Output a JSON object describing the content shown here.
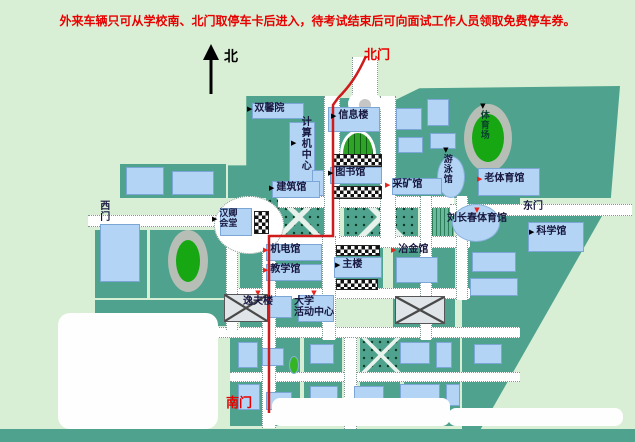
{
  "header": {
    "notice": "外来车辆只可从学校南、北门取停车卡后进入，待考试结束后可向面试工作人员领取免费停车券。",
    "north_label": "北"
  },
  "palette": {
    "background": "#d9efd5",
    "parcel_teal": "#4fa28d",
    "building_blue": "#b3d4f4",
    "route_red": "#cf1b1b",
    "gate_red": "#e80000",
    "field_green": "#17a713",
    "track_gray": "#b7beb5",
    "label_dark": "#17173f"
  },
  "map": {
    "parcels": [
      {
        "type": "teal",
        "x": 392,
        "y": 86,
        "w": 228,
        "h": 112,
        "clip": "polygon(0 14%, 12% 2%, 100% 0, 96% 100%, 0 100%)"
      },
      {
        "type": "teal",
        "x": 462,
        "y": 216,
        "w": 140,
        "h": 214,
        "clip": "polygon(0 0, 100% 0, 13% 100%, 0 100%)"
      },
      {
        "type": "teal",
        "x": 326,
        "y": 98,
        "w": 58,
        "h": 100
      },
      {
        "type": "teal",
        "x": 228,
        "y": 96,
        "w": 96,
        "h": 102,
        "clip": "polygon(19% 0,100% 0,100% 100%,0 100%,0 68%,19% 68%)"
      },
      {
        "type": "teal",
        "x": 120,
        "y": 164,
        "w": 106,
        "h": 34
      },
      {
        "type": "teal",
        "x": 95,
        "y": 230,
        "w": 52,
        "h": 68
      },
      {
        "type": "teal",
        "x": 150,
        "y": 230,
        "w": 80,
        "h": 68
      },
      {
        "type": "teal",
        "x": 95,
        "y": 300,
        "w": 133,
        "h": 26
      },
      {
        "type": "teal",
        "x": 240,
        "y": 244,
        "w": 82,
        "h": 46
      },
      {
        "type": "teal",
        "x": 335,
        "y": 244,
        "w": 48,
        "h": 46
      },
      {
        "type": "teal",
        "x": 393,
        "y": 244,
        "w": 62,
        "h": 46
      },
      {
        "type": "teal",
        "x": 240,
        "y": 292,
        "w": 92,
        "h": 36
      },
      {
        "type": "teal",
        "x": 393,
        "y": 292,
        "w": 62,
        "h": 36
      },
      {
        "type": "teal",
        "x": 466,
        "y": 197,
        "w": 54,
        "h": 48
      },
      {
        "type": "teal",
        "x": 230,
        "y": 338,
        "w": 70,
        "h": 34
      },
      {
        "type": "teal",
        "x": 304,
        "y": 338,
        "w": 38,
        "h": 34
      },
      {
        "type": "teal",
        "x": 394,
        "y": 338,
        "w": 66,
        "h": 34
      },
      {
        "type": "teal",
        "x": 230,
        "y": 378,
        "w": 70,
        "h": 48
      },
      {
        "type": "teal",
        "x": 304,
        "y": 378,
        "w": 38,
        "h": 48
      },
      {
        "type": "teal",
        "x": 360,
        "y": 378,
        "w": 40,
        "h": 48
      },
      {
        "type": "teal",
        "x": 404,
        "y": 378,
        "w": 56,
        "h": 48
      },
      {
        "type": "band",
        "x": 0,
        "y": 429,
        "w": 635,
        "h": 13
      },
      {
        "type": "park",
        "x": 266,
        "y": 197,
        "w": 66,
        "h": 40
      },
      {
        "type": "park",
        "x": 344,
        "y": 197,
        "w": 74,
        "h": 40
      },
      {
        "type": "grass",
        "x": 420,
        "y": 199,
        "w": 34,
        "h": 40
      },
      {
        "type": "park",
        "x": 360,
        "y": 338,
        "w": 42,
        "h": 34
      },
      {
        "type": "hatch",
        "x": 224,
        "y": 294,
        "w": 44,
        "h": 28
      },
      {
        "type": "hatch",
        "x": 395,
        "y": 296,
        "w": 50,
        "h": 28
      }
    ],
    "roads": [
      {
        "dir": "h",
        "x": 88,
        "y": 215,
        "w": 132,
        "h": 12
      },
      {
        "dir": "h",
        "x": 278,
        "y": 196,
        "w": 176,
        "h": 12
      },
      {
        "dir": "h",
        "x": 450,
        "y": 204,
        "w": 182,
        "h": 12
      },
      {
        "dir": "h",
        "x": 262,
        "y": 236,
        "w": 208,
        "h": 12
      },
      {
        "dir": "h",
        "x": 232,
        "y": 288,
        "w": 238,
        "h": 11
      },
      {
        "dir": "h",
        "x": 120,
        "y": 327,
        "w": 400,
        "h": 11
      },
      {
        "dir": "h",
        "x": 230,
        "y": 372,
        "w": 290,
        "h": 10
      },
      {
        "dir": "v",
        "x": 352,
        "y": 57,
        "w": 26,
        "h": 40
      },
      {
        "dir": "v",
        "x": 324,
        "y": 96,
        "w": 16,
        "h": 142
      },
      {
        "dir": "v",
        "x": 380,
        "y": 96,
        "w": 16,
        "h": 142
      },
      {
        "dir": "v",
        "x": 226,
        "y": 210,
        "w": 12,
        "h": 120
      },
      {
        "dir": "v",
        "x": 262,
        "y": 236,
        "w": 14,
        "h": 192
      },
      {
        "dir": "v",
        "x": 322,
        "y": 236,
        "w": 14,
        "h": 104
      },
      {
        "dir": "v",
        "x": 420,
        "y": 196,
        "w": 12,
        "h": 144
      },
      {
        "dir": "v",
        "x": 456,
        "y": 196,
        "w": 12,
        "h": 104
      },
      {
        "dir": "v",
        "x": 344,
        "y": 338,
        "w": 13,
        "h": 91
      }
    ],
    "specials": [
      {
        "type": "island",
        "x": 214,
        "y": 196,
        "w": 68,
        "h": 56
      },
      {
        "type": "plaza",
        "x": 348,
        "y": 90,
        "w": 34,
        "h": 28
      },
      {
        "type": "dot",
        "x": 359,
        "y": 99,
        "w": 12,
        "h": 12
      },
      {
        "type": "blob",
        "x": 58,
        "y": 313,
        "w": 160,
        "h": 116,
        "rx": "12px"
      },
      {
        "type": "blob",
        "x": 272,
        "y": 398,
        "w": 178,
        "h": 28,
        "rx": "8px"
      },
      {
        "type": "blob",
        "x": 448,
        "y": 408,
        "w": 175,
        "h": 18,
        "rx": "8px"
      }
    ],
    "stadiums": [
      {
        "x": 168,
        "y": 230,
        "w": 40,
        "h": 62,
        "inset": "10px 8px"
      },
      {
        "x": 464,
        "y": 104,
        "w": 48,
        "h": 68,
        "inset": "10px 8px"
      }
    ],
    "ellipses": [
      {
        "x": 437,
        "y": 156,
        "w": 28,
        "h": 42,
        "c": "#b3d4f4"
      },
      {
        "x": 452,
        "y": 204,
        "w": 48,
        "h": 38,
        "c": "#b3d4f4"
      },
      {
        "x": 289,
        "y": 356,
        "w": 10,
        "h": 18,
        "c": "#35b524"
      }
    ],
    "dome": {
      "x": 340,
      "y": 130,
      "w": 36,
      "h": 24
    },
    "checkers": [
      {
        "x": 332,
        "y": 154,
        "w": 50,
        "h": 13
      },
      {
        "x": 332,
        "y": 186,
        "w": 50,
        "h": 13
      },
      {
        "x": 336,
        "y": 245,
        "w": 44,
        "h": 11
      },
      {
        "x": 336,
        "y": 279,
        "w": 42,
        "h": 11
      },
      {
        "x": 254,
        "y": 211,
        "w": 15,
        "h": 23
      }
    ],
    "buildings": [
      {
        "x": 126,
        "y": 167,
        "w": 38,
        "h": 28
      },
      {
        "x": 172,
        "y": 171,
        "w": 42,
        "h": 24
      },
      {
        "x": 100,
        "y": 224,
        "w": 40,
        "h": 58
      },
      {
        "x": 252,
        "y": 103,
        "w": 52,
        "h": 16
      },
      {
        "x": 289,
        "y": 122,
        "w": 26,
        "h": 60
      },
      {
        "x": 312,
        "y": 170,
        "w": 12,
        "h": 26
      },
      {
        "x": 272,
        "y": 181,
        "w": 48,
        "h": 17
      },
      {
        "x": 328,
        "y": 107,
        "w": 52,
        "h": 25
      },
      {
        "x": 330,
        "y": 167,
        "w": 52,
        "h": 17
      },
      {
        "x": 396,
        "y": 108,
        "w": 26,
        "h": 22
      },
      {
        "x": 427,
        "y": 99,
        "w": 22,
        "h": 27
      },
      {
        "x": 398,
        "y": 137,
        "w": 25,
        "h": 16
      },
      {
        "x": 430,
        "y": 133,
        "w": 26,
        "h": 16
      },
      {
        "x": 392,
        "y": 178,
        "w": 50,
        "h": 17
      },
      {
        "x": 478,
        "y": 168,
        "w": 62,
        "h": 28
      },
      {
        "x": 528,
        "y": 222,
        "w": 56,
        "h": 30
      },
      {
        "x": 266,
        "y": 244,
        "w": 56,
        "h": 17
      },
      {
        "x": 266,
        "y": 264,
        "w": 56,
        "h": 17
      },
      {
        "x": 334,
        "y": 257,
        "w": 48,
        "h": 21
      },
      {
        "x": 396,
        "y": 257,
        "w": 42,
        "h": 26
      },
      {
        "x": 262,
        "y": 296,
        "w": 30,
        "h": 22
      },
      {
        "x": 298,
        "y": 295,
        "w": 36,
        "h": 27
      },
      {
        "x": 472,
        "y": 252,
        "w": 44,
        "h": 20
      },
      {
        "x": 470,
        "y": 278,
        "w": 48,
        "h": 18
      },
      {
        "x": 238,
        "y": 342,
        "w": 20,
        "h": 26
      },
      {
        "x": 262,
        "y": 348,
        "w": 22,
        "h": 18
      },
      {
        "x": 310,
        "y": 344,
        "w": 24,
        "h": 20
      },
      {
        "x": 400,
        "y": 342,
        "w": 30,
        "h": 22
      },
      {
        "x": 436,
        "y": 342,
        "w": 16,
        "h": 26
      },
      {
        "x": 474,
        "y": 344,
        "w": 28,
        "h": 20
      },
      {
        "x": 238,
        "y": 384,
        "w": 22,
        "h": 26
      },
      {
        "x": 266,
        "y": 392,
        "w": 26,
        "h": 18
      },
      {
        "x": 310,
        "y": 386,
        "w": 28,
        "h": 20
      },
      {
        "x": 354,
        "y": 386,
        "w": 30,
        "h": 20
      },
      {
        "x": 400,
        "y": 384,
        "w": 40,
        "h": 16
      },
      {
        "x": 446,
        "y": 384,
        "w": 14,
        "h": 22
      },
      {
        "x": 300,
        "y": 412,
        "w": 26,
        "h": 12
      },
      {
        "x": 334,
        "y": 408,
        "w": 24,
        "h": 14
      },
      {
        "x": 220,
        "y": 208,
        "w": 32,
        "h": 28
      }
    ],
    "route": {
      "path": "M 366 56 C 358 74 350 86 338 98 L 333 105 L 333 236 L 269 236 L 269 413",
      "color": "#cf1b1b"
    },
    "labels": [
      {
        "t": "北门",
        "n": "north-gate-label",
        "x": 364,
        "y": 49,
        "s": 13,
        "gate": true
      },
      {
        "t": "南门",
        "n": "south-gate-label",
        "x": 226,
        "y": 397,
        "s": 13,
        "gate": true
      },
      {
        "t": "西门",
        "n": "west-gate-label",
        "x": 97,
        "y": 200,
        "s": 10,
        "v": true
      },
      {
        "t": "东门",
        "n": "east-gate-label",
        "x": 523,
        "y": 202,
        "s": 10
      },
      {
        "t": "双馨院",
        "n": "shuangxinyuan-label",
        "x": 247,
        "y": 104,
        "s": 10,
        "m": "r-black"
      },
      {
        "t": "计算机中心",
        "n": "computer-center-label",
        "x": 291,
        "y": 116,
        "s": 10,
        "m": "r-black",
        "v": true
      },
      {
        "t": "信息楼",
        "n": "information-building-label",
        "x": 331,
        "y": 111,
        "s": 10,
        "m": "r-black"
      },
      {
        "t": "图书馆",
        "n": "library-label",
        "x": 328,
        "y": 168,
        "s": 10,
        "m": "r-black"
      },
      {
        "t": "建筑馆",
        "n": "architecture-hall-label",
        "x": 269,
        "y": 183,
        "s": 10,
        "m": "r-black"
      },
      {
        "t": "汉卿\n会堂",
        "n": "hanqing-hall-label",
        "x": 212,
        "y": 210,
        "s": 9,
        "m": "r-black"
      },
      {
        "t": "采矿馆",
        "n": "mining-hall-label",
        "x": 385,
        "y": 180,
        "s": 10,
        "m": "r-red"
      },
      {
        "t": "体育场",
        "n": "stadium-label",
        "x": 478,
        "y": 103,
        "s": 9,
        "m": "d-black",
        "v": true,
        "c": "#083f2e"
      },
      {
        "t": "游泳馆",
        "n": "swimming-hall-label",
        "x": 441,
        "y": 147,
        "s": 9,
        "m": "d-black",
        "v": true
      },
      {
        "t": "老体育馆",
        "n": "old-gym-label",
        "x": 477,
        "y": 174,
        "s": 10,
        "m": "r-red"
      },
      {
        "t": "刘长春体育馆",
        "n": "liuchangchun-gym-label",
        "x": 447,
        "y": 207,
        "s": 10,
        "m": "d-red"
      },
      {
        "t": "科学馆",
        "n": "science-hall-label",
        "x": 529,
        "y": 227,
        "s": 10,
        "m": "r-black"
      },
      {
        "t": "机电馆",
        "n": "mechatronics-hall-label",
        "x": 263,
        "y": 245,
        "s": 10,
        "m": "r-red"
      },
      {
        "t": "教学馆",
        "n": "teaching-hall-label",
        "x": 263,
        "y": 265,
        "s": 10,
        "m": "r-red"
      },
      {
        "t": "主楼",
        "n": "main-building-label",
        "x": 335,
        "y": 260,
        "s": 10,
        "m": "r-black"
      },
      {
        "t": "冶金馆",
        "n": "metallurgy-hall-label",
        "x": 391,
        "y": 245,
        "s": 10,
        "m": "r-red"
      },
      {
        "t": "逸夫楼",
        "n": "yifu-building-label",
        "x": 243,
        "y": 290,
        "s": 10,
        "m": "d-red"
      },
      {
        "t": "大学\n活动中心",
        "n": "university-activity-center-label",
        "x": 294,
        "y": 290,
        "s": 10,
        "m": "d-red"
      }
    ]
  }
}
